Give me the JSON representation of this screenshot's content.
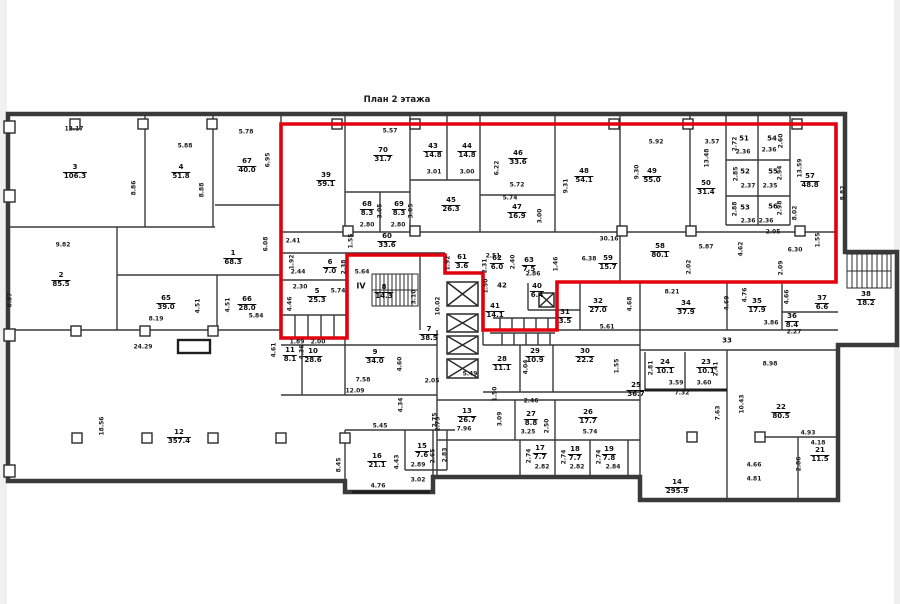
{
  "title": "План 2 этажа",
  "colors": {
    "highlight": "#e2000f",
    "walls": "#3a3a3a",
    "text": "#0d0d0d"
  },
  "highlight": {
    "points": "281,124 836,124 836,282 557,282 557,330 483,330 483,273 445,273 445,255 347,255 347,338 281,338"
  },
  "annotations": [
    {
      "t": "IV",
      "x": 361,
      "y": 286
    }
  ],
  "rooms": [
    {
      "n": "3",
      "a": "106.3",
      "x": 75,
      "y": 172
    },
    {
      "n": "4",
      "a": "51.8",
      "x": 181,
      "y": 172
    },
    {
      "n": "67",
      "a": "40.0",
      "x": 247,
      "y": 166
    },
    {
      "n": "1",
      "a": "68.3",
      "x": 233,
      "y": 258
    },
    {
      "n": "2",
      "a": "85.5",
      "x": 61,
      "y": 280
    },
    {
      "n": "65",
      "a": "39.0",
      "x": 166,
      "y": 303
    },
    {
      "n": "66",
      "a": "28.0",
      "x": 247,
      "y": 304
    },
    {
      "n": "12",
      "a": "357.4",
      "x": 179,
      "y": 437
    },
    {
      "n": "39",
      "a": "59.1",
      "x": 326,
      "y": 180
    },
    {
      "n": "70",
      "a": "31.7",
      "x": 383,
      "y": 155
    },
    {
      "n": "43",
      "a": "14.8",
      "x": 433,
      "y": 151
    },
    {
      "n": "44",
      "a": "14.8",
      "x": 467,
      "y": 151
    },
    {
      "n": "46",
      "a": "33.6",
      "x": 518,
      "y": 158
    },
    {
      "n": "68",
      "a": "8.3",
      "x": 367,
      "y": 209
    },
    {
      "n": "69",
      "a": "8.3",
      "x": 399,
      "y": 209
    },
    {
      "n": "45",
      "a": "26.3",
      "x": 451,
      "y": 205
    },
    {
      "n": "47",
      "a": "16.9",
      "x": 517,
      "y": 212
    },
    {
      "n": "60",
      "a": "33.6",
      "x": 387,
      "y": 241
    },
    {
      "n": "48",
      "a": "54.1",
      "x": 584,
      "y": 176
    },
    {
      "n": "49",
      "a": "55.0",
      "x": 652,
      "y": 176
    },
    {
      "n": "50",
      "a": "31.4",
      "x": 706,
      "y": 188
    },
    {
      "n": "51",
      "a": "",
      "x": 744,
      "y": 139
    },
    {
      "n": "54",
      "a": "",
      "x": 772,
      "y": 139
    },
    {
      "n": "52",
      "a": "",
      "x": 745,
      "y": 172
    },
    {
      "n": "55",
      "a": "",
      "x": 773,
      "y": 172
    },
    {
      "n": "53",
      "a": "",
      "x": 745,
      "y": 208
    },
    {
      "n": "56",
      "a": "",
      "x": 773,
      "y": 207
    },
    {
      "n": "57",
      "a": "48.8",
      "x": 810,
      "y": 181
    },
    {
      "n": "58",
      "a": "80.1",
      "x": 660,
      "y": 251
    },
    {
      "n": "59",
      "a": "15.7",
      "x": 608,
      "y": 263
    },
    {
      "n": "5",
      "a": "25.3",
      "x": 317,
      "y": 296
    },
    {
      "n": "6",
      "a": "7.0",
      "x": 330,
      "y": 267
    },
    {
      "n": "8",
      "a": "14.3",
      "x": 384,
      "y": 292
    },
    {
      "n": "7",
      "a": "38.5",
      "x": 429,
      "y": 334
    },
    {
      "n": "9",
      "a": "34.0",
      "x": 375,
      "y": 357
    },
    {
      "n": "10",
      "a": "28.6",
      "x": 313,
      "y": 356
    },
    {
      "n": "11",
      "a": "8.1",
      "x": 290,
      "y": 355
    },
    {
      "n": "61",
      "a": "3.6",
      "x": 462,
      "y": 262
    },
    {
      "n": "62",
      "a": "6.0",
      "x": 497,
      "y": 263
    },
    {
      "n": "63",
      "a": "7.5",
      "x": 529,
      "y": 265
    },
    {
      "n": "42",
      "a": "",
      "x": 502,
      "y": 286
    },
    {
      "n": "40",
      "a": "6.4",
      "x": 537,
      "y": 291
    },
    {
      "n": "41",
      "a": "14.1",
      "x": 495,
      "y": 311
    },
    {
      "n": "28",
      "a": "11.1",
      "x": 502,
      "y": 364
    },
    {
      "n": "29",
      "a": "10.9",
      "x": 535,
      "y": 356
    },
    {
      "n": "30",
      "a": "22.2",
      "x": 585,
      "y": 356
    },
    {
      "n": "31",
      "a": "3.5",
      "x": 565,
      "y": 317
    },
    {
      "n": "32",
      "a": "27.0",
      "x": 598,
      "y": 306
    },
    {
      "n": "34",
      "a": "37.9",
      "x": 686,
      "y": 308
    },
    {
      "n": "35",
      "a": "17.9",
      "x": 757,
      "y": 306
    },
    {
      "n": "36",
      "a": "8.4",
      "x": 792,
      "y": 321
    },
    {
      "n": "37",
      "a": "6.6",
      "x": 822,
      "y": 303
    },
    {
      "n": "38",
      "a": "18.2",
      "x": 866,
      "y": 299
    },
    {
      "n": "33",
      "a": "",
      "x": 727,
      "y": 341
    },
    {
      "n": "24",
      "a": "10.1",
      "x": 665,
      "y": 367
    },
    {
      "n": "23",
      "a": "10.1",
      "x": 706,
      "y": 367
    },
    {
      "n": "25",
      "a": "36.7",
      "x": 636,
      "y": 390
    },
    {
      "n": "22",
      "a": "80.5",
      "x": 781,
      "y": 412
    },
    {
      "n": "21",
      "a": "11.5",
      "x": 820,
      "y": 455
    },
    {
      "n": "14",
      "a": "295.9",
      "x": 677,
      "y": 487
    },
    {
      "n": "13",
      "a": "26.7",
      "x": 467,
      "y": 416
    },
    {
      "n": "27",
      "a": "8.8",
      "x": 531,
      "y": 419
    },
    {
      "n": "26",
      "a": "17.7",
      "x": 588,
      "y": 417
    },
    {
      "n": "16",
      "a": "21.1",
      "x": 377,
      "y": 461
    },
    {
      "n": "15",
      "a": "7.6",
      "x": 422,
      "y": 451
    },
    {
      "n": "17",
      "a": "7.7",
      "x": 540,
      "y": 453
    },
    {
      "n": "18",
      "a": "7.7",
      "x": 575,
      "y": 454
    },
    {
      "n": "19",
      "a": "7.8",
      "x": 609,
      "y": 454
    }
  ],
  "dimensions": [
    {
      "t": "12.17",
      "x": 74,
      "y": 129,
      "o": "h"
    },
    {
      "t": "5.88",
      "x": 185,
      "y": 146,
      "o": "h"
    },
    {
      "t": "5.78",
      "x": 246,
      "y": 132,
      "o": "h"
    },
    {
      "t": "6.95",
      "x": 268,
      "y": 160,
      "o": "v"
    },
    {
      "t": "8.86",
      "x": 134,
      "y": 188,
      "o": "v"
    },
    {
      "t": "8.88",
      "x": 202,
      "y": 190,
      "o": "v"
    },
    {
      "t": "9.82",
      "x": 63,
      "y": 245,
      "o": "h"
    },
    {
      "t": "8.87",
      "x": 10,
      "y": 300,
      "o": "v"
    },
    {
      "t": "6.08",
      "x": 266,
      "y": 244,
      "o": "v"
    },
    {
      "t": "2.41",
      "x": 293,
      "y": 241,
      "o": "h"
    },
    {
      "t": "8.19",
      "x": 156,
      "y": 319,
      "o": "h"
    },
    {
      "t": "24.29",
      "x": 143,
      "y": 347,
      "o": "h"
    },
    {
      "t": "5.84",
      "x": 256,
      "y": 316,
      "o": "h"
    },
    {
      "t": "4.51",
      "x": 198,
      "y": 306,
      "o": "v"
    },
    {
      "t": "4.51",
      "x": 228,
      "y": 305,
      "o": "v"
    },
    {
      "t": "18.56",
      "x": 102,
      "y": 426,
      "o": "v"
    },
    {
      "t": "8.45",
      "x": 339,
      "y": 465,
      "o": "v"
    },
    {
      "t": "5.57",
      "x": 390,
      "y": 131,
      "o": "h"
    },
    {
      "t": "3.01",
      "x": 434,
      "y": 172,
      "o": "h"
    },
    {
      "t": "3.00",
      "x": 467,
      "y": 172,
      "o": "h"
    },
    {
      "t": "6.22",
      "x": 497,
      "y": 168,
      "o": "v"
    },
    {
      "t": "5.72",
      "x": 517,
      "y": 185,
      "o": "h"
    },
    {
      "t": "5.74",
      "x": 510,
      "y": 198,
      "o": "h"
    },
    {
      "t": "3.00",
      "x": 540,
      "y": 216,
      "o": "v"
    },
    {
      "t": "9.31",
      "x": 566,
      "y": 186,
      "o": "v"
    },
    {
      "t": "9.30",
      "x": 637,
      "y": 172,
      "o": "v"
    },
    {
      "t": "5.92",
      "x": 656,
      "y": 142,
      "o": "h"
    },
    {
      "t": "3.57",
      "x": 712,
      "y": 142,
      "o": "h"
    },
    {
      "t": "13.48",
      "x": 707,
      "y": 158,
      "o": "v"
    },
    {
      "t": "13.59",
      "x": 800,
      "y": 168,
      "o": "v"
    },
    {
      "t": "2.72",
      "x": 735,
      "y": 144,
      "o": "v"
    },
    {
      "t": "2.36",
      "x": 743,
      "y": 152,
      "o": "h"
    },
    {
      "t": "2.60",
      "x": 781,
      "y": 141,
      "o": "v"
    },
    {
      "t": "2.36",
      "x": 769,
      "y": 150,
      "o": "h"
    },
    {
      "t": "2.85",
      "x": 736,
      "y": 174,
      "o": "v"
    },
    {
      "t": "2.37",
      "x": 748,
      "y": 186,
      "o": "h"
    },
    {
      "t": "2.94",
      "x": 780,
      "y": 173,
      "o": "v"
    },
    {
      "t": "2.35",
      "x": 770,
      "y": 186,
      "o": "h"
    },
    {
      "t": "2.88",
      "x": 735,
      "y": 209,
      "o": "v"
    },
    {
      "t": "2.36",
      "x": 748,
      "y": 221,
      "o": "h"
    },
    {
      "t": "2.98",
      "x": 780,
      "y": 208,
      "o": "v"
    },
    {
      "t": "2.36",
      "x": 766,
      "y": 221,
      "o": "h"
    },
    {
      "t": "2.05",
      "x": 773,
      "y": 232,
      "o": "h"
    },
    {
      "t": "8.02",
      "x": 795,
      "y": 213,
      "o": "v"
    },
    {
      "t": "8.82",
      "x": 843,
      "y": 193,
      "o": "v"
    },
    {
      "t": "3.05",
      "x": 380,
      "y": 211,
      "o": "v"
    },
    {
      "t": "3.05",
      "x": 411,
      "y": 211,
      "o": "v"
    },
    {
      "t": "2.80",
      "x": 367,
      "y": 225,
      "o": "h"
    },
    {
      "t": "2.80",
      "x": 398,
      "y": 225,
      "o": "h"
    },
    {
      "t": "1.55",
      "x": 351,
      "y": 241,
      "o": "v"
    },
    {
      "t": "1.55",
      "x": 818,
      "y": 240,
      "o": "v"
    },
    {
      "t": "30.16",
      "x": 609,
      "y": 239,
      "o": "h"
    },
    {
      "t": "6.38",
      "x": 589,
      "y": 259,
      "o": "h"
    },
    {
      "t": "5.87",
      "x": 706,
      "y": 247,
      "o": "h"
    },
    {
      "t": "2.02",
      "x": 689,
      "y": 267,
      "o": "v"
    },
    {
      "t": "4.62",
      "x": 741,
      "y": 249,
      "o": "v"
    },
    {
      "t": "6.30",
      "x": 795,
      "y": 250,
      "o": "h"
    },
    {
      "t": "2.09",
      "x": 781,
      "y": 268,
      "o": "v"
    },
    {
      "t": "2.44",
      "x": 298,
      "y": 272,
      "o": "h"
    },
    {
      "t": "1.92",
      "x": 292,
      "y": 262,
      "o": "v"
    },
    {
      "t": "2.38",
      "x": 344,
      "y": 267,
      "o": "v"
    },
    {
      "t": "2.30",
      "x": 300,
      "y": 287,
      "o": "h"
    },
    {
      "t": "5.74",
      "x": 338,
      "y": 291,
      "o": "h"
    },
    {
      "t": "4.46",
      "x": 290,
      "y": 304,
      "o": "v"
    },
    {
      "t": "1.89",
      "x": 297,
      "y": 342,
      "o": "h"
    },
    {
      "t": "2.00",
      "x": 318,
      "y": 342,
      "o": "h"
    },
    {
      "t": "5.64",
      "x": 362,
      "y": 272,
      "o": "h"
    },
    {
      "t": "3.10",
      "x": 414,
      "y": 297,
      "o": "v"
    },
    {
      "t": "10.02",
      "x": 438,
      "y": 306,
      "o": "v"
    },
    {
      "t": "4.60",
      "x": 400,
      "y": 364,
      "o": "v"
    },
    {
      "t": "7.58",
      "x": 363,
      "y": 380,
      "o": "h"
    },
    {
      "t": "12.09",
      "x": 355,
      "y": 391,
      "o": "h"
    },
    {
      "t": "2.05",
      "x": 432,
      "y": 381,
      "o": "h"
    },
    {
      "t": "2.73",
      "x": 438,
      "y": 424,
      "o": "v"
    },
    {
      "t": "4.61",
      "x": 274,
      "y": 350,
      "o": "v"
    },
    {
      "t": "4.36",
      "x": 302,
      "y": 352,
      "o": "v"
    },
    {
      "t": "1.92",
      "x": 448,
      "y": 263,
      "o": "v"
    },
    {
      "t": "2.51",
      "x": 493,
      "y": 256,
      "o": "h"
    },
    {
      "t": "2.31",
      "x": 485,
      "y": 266,
      "o": "v"
    },
    {
      "t": "2.40",
      "x": 513,
      "y": 262,
      "o": "v"
    },
    {
      "t": "2.86",
      "x": 533,
      "y": 274,
      "o": "h"
    },
    {
      "t": "1.50",
      "x": 486,
      "y": 286,
      "o": "v"
    },
    {
      "t": "1.46",
      "x": 556,
      "y": 264,
      "o": "v"
    },
    {
      "t": "5.49",
      "x": 470,
      "y": 374,
      "o": "h"
    },
    {
      "t": "4.04",
      "x": 526,
      "y": 367,
      "o": "v"
    },
    {
      "t": "1.55",
      "x": 617,
      "y": 366,
      "o": "v"
    },
    {
      "t": "5.61",
      "x": 607,
      "y": 327,
      "o": "h"
    },
    {
      "t": "4.68",
      "x": 630,
      "y": 304,
      "o": "v"
    },
    {
      "t": "8.21",
      "x": 672,
      "y": 292,
      "o": "h"
    },
    {
      "t": "4.69",
      "x": 727,
      "y": 303,
      "o": "v"
    },
    {
      "t": "4.76",
      "x": 745,
      "y": 295,
      "o": "v"
    },
    {
      "t": "3.86",
      "x": 771,
      "y": 323,
      "o": "h"
    },
    {
      "t": "2.27",
      "x": 794,
      "y": 332,
      "o": "h"
    },
    {
      "t": "4.66",
      "x": 787,
      "y": 297,
      "o": "v"
    },
    {
      "t": "8.98",
      "x": 770,
      "y": 364,
      "o": "h"
    },
    {
      "t": "2.81",
      "x": 651,
      "y": 368,
      "o": "v"
    },
    {
      "t": "2.41",
      "x": 716,
      "y": 369,
      "o": "v"
    },
    {
      "t": "3.59",
      "x": 676,
      "y": 383,
      "o": "h"
    },
    {
      "t": "3.60",
      "x": 704,
      "y": 383,
      "o": "h"
    },
    {
      "t": "7.32",
      "x": 682,
      "y": 393,
      "o": "h"
    },
    {
      "t": "7.63",
      "x": 718,
      "y": 413,
      "o": "v"
    },
    {
      "t": "10.43",
      "x": 742,
      "y": 404,
      "o": "v"
    },
    {
      "t": "4.66",
      "x": 754,
      "y": 465,
      "o": "h"
    },
    {
      "t": "4.81",
      "x": 754,
      "y": 479,
      "o": "h"
    },
    {
      "t": "4.93",
      "x": 808,
      "y": 433,
      "o": "h"
    },
    {
      "t": "4.18",
      "x": 818,
      "y": 443,
      "o": "h"
    },
    {
      "t": "2.86",
      "x": 799,
      "y": 464,
      "o": "v"
    },
    {
      "t": "5.45",
      "x": 380,
      "y": 426,
      "o": "h"
    },
    {
      "t": "4.34",
      "x": 401,
      "y": 405,
      "o": "v"
    },
    {
      "t": "2.75",
      "x": 435,
      "y": 420,
      "o": "v"
    },
    {
      "t": "7.96",
      "x": 464,
      "y": 429,
      "o": "h"
    },
    {
      "t": "3.09",
      "x": 500,
      "y": 419,
      "o": "v"
    },
    {
      "t": "1.50",
      "x": 495,
      "y": 394,
      "o": "v"
    },
    {
      "t": "2.46",
      "x": 531,
      "y": 401,
      "o": "h"
    },
    {
      "t": "3.25",
      "x": 528,
      "y": 432,
      "o": "h"
    },
    {
      "t": "2.50",
      "x": 547,
      "y": 426,
      "o": "v"
    },
    {
      "t": "5.74",
      "x": 590,
      "y": 432,
      "o": "h"
    },
    {
      "t": "2.82",
      "x": 542,
      "y": 467,
      "o": "h"
    },
    {
      "t": "2.82",
      "x": 577,
      "y": 467,
      "o": "h"
    },
    {
      "t": "2.84",
      "x": 613,
      "y": 467,
      "o": "h"
    },
    {
      "t": "2.74",
      "x": 529,
      "y": 456,
      "o": "v"
    },
    {
      "t": "2.74",
      "x": 564,
      "y": 457,
      "o": "v"
    },
    {
      "t": "2.74",
      "x": 599,
      "y": 457,
      "o": "v"
    },
    {
      "t": "4.43",
      "x": 397,
      "y": 462,
      "o": "v"
    },
    {
      "t": "2.89",
      "x": 418,
      "y": 465,
      "o": "h"
    },
    {
      "t": "2.65",
      "x": 433,
      "y": 456,
      "o": "v"
    },
    {
      "t": "2.83",
      "x": 445,
      "y": 455,
      "o": "v"
    },
    {
      "t": "3.02",
      "x": 418,
      "y": 480,
      "o": "h"
    },
    {
      "t": "4.76",
      "x": 378,
      "y": 486,
      "o": "h"
    }
  ]
}
